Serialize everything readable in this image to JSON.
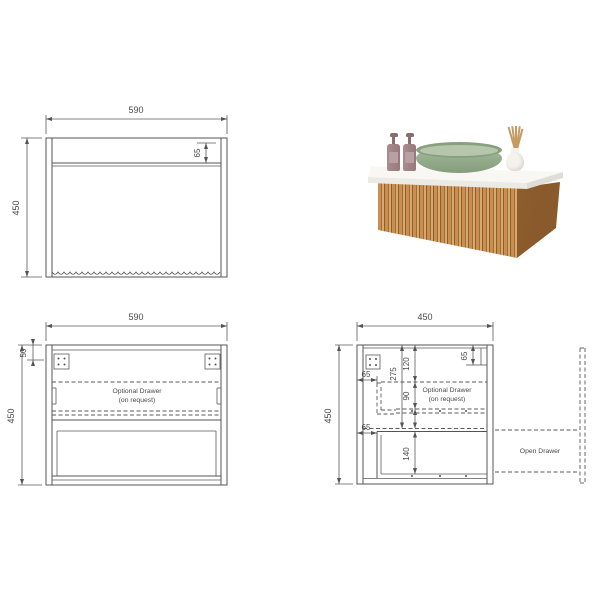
{
  "front_view": {
    "width": "590",
    "height": "450",
    "top_rail": "65"
  },
  "front_open_view": {
    "width": "590",
    "height": "450",
    "top_rail": "50",
    "note_line1": "Optional Drawer",
    "note_line2": "(on request)"
  },
  "side_view": {
    "width": "450",
    "height": "450",
    "overall_depth": "275",
    "top_section": "120",
    "mid_section": "90",
    "back_rail": "65",
    "front_inset_upper": "65",
    "front_inset_lower": "65",
    "drawer_front_height": "140",
    "note_line1": "Optional Drawer",
    "note_line2": "(on request)",
    "open_drawer_label": "Open Drawer"
  },
  "colors": {
    "line": "#545454",
    "dim_text": "#4a4a4a",
    "wood_light": "#d8a96c",
    "wood_mid": "#c98f52",
    "wood_dark": "#8f5c2a",
    "countertop": "#f8f7f4",
    "basin_green": "#9cb493",
    "bottle_mauve": "#a28486",
    "vase_white": "#f4f2ed",
    "reed_tan": "#c59a63",
    "background": "#ffffff"
  }
}
